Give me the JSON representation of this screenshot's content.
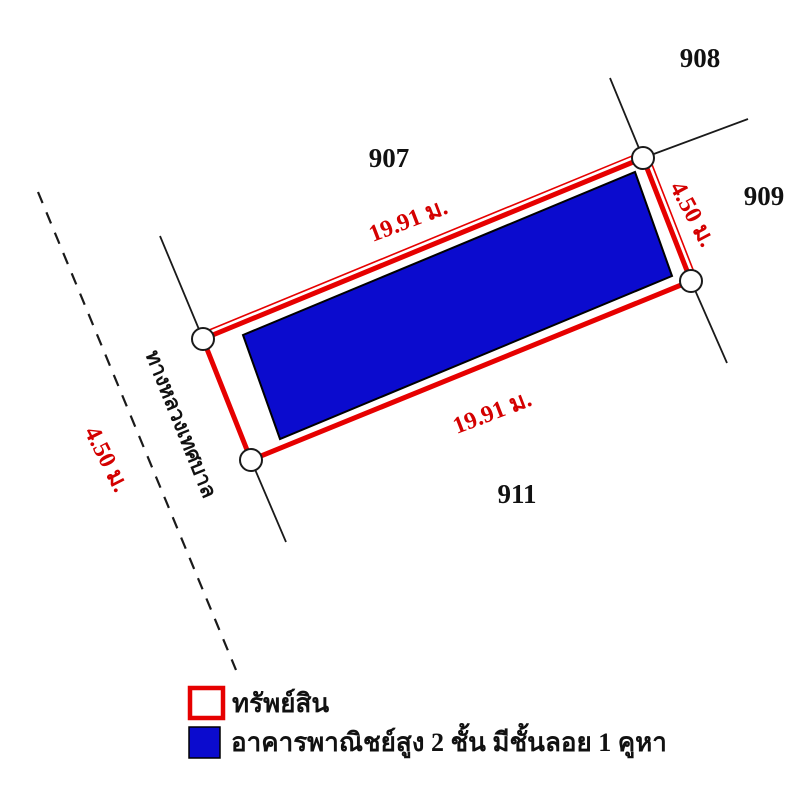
{
  "diagram": {
    "parcels": {
      "p907": "907",
      "p908": "908",
      "p909": "909",
      "p911": "911"
    },
    "dimensions": {
      "top_length": "19.91 ม.",
      "bottom_length": "19.91 ม.",
      "right_width": "4.50 ม.",
      "road_width": "4.50 ม."
    },
    "road_label": "ทางหลวงเทศบาล"
  },
  "legend": {
    "property_label": "ทรัพย์สิน",
    "building_label": "อาคารพาณิชย์สูง 2 ชั้น มีชั้นลอย 1 คูหา"
  },
  "colors": {
    "boundary_red": "#e60000",
    "dimension_red": "#d40000",
    "building_blue": "#0b0bce",
    "line_black": "#1a1a1a"
  }
}
